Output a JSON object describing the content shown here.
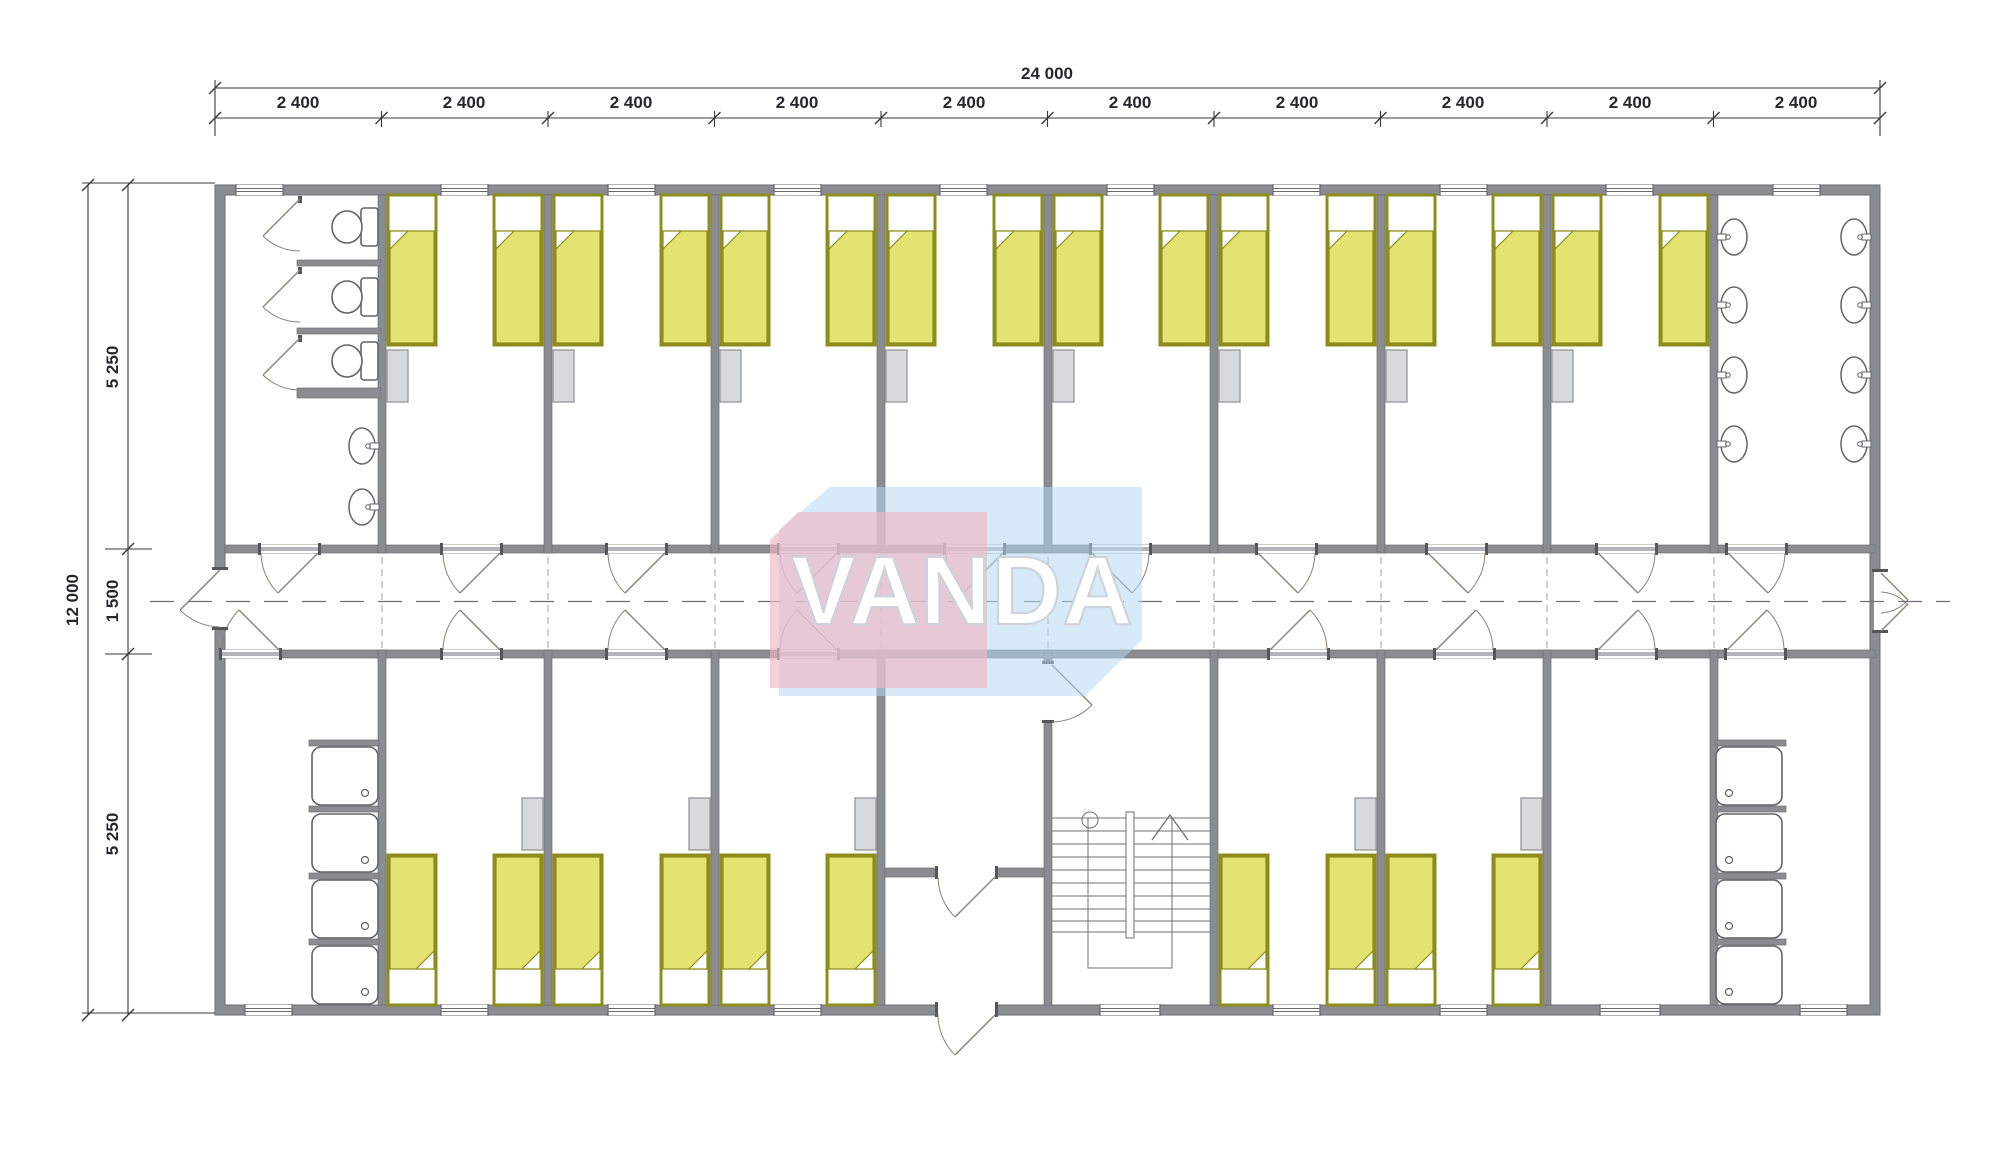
{
  "watermark": {
    "text": "VANDA",
    "pink_color": "#eeb7c4",
    "blue_color": "#b5d8f0"
  },
  "dimensions": {
    "top_total": "24 000",
    "top_bays": [
      "2 400",
      "2 400",
      "2 400",
      "2 400",
      "2 400",
      "2 400",
      "2 400",
      "2 400",
      "2 400",
      "2 400"
    ],
    "left_total": "12 000",
    "left_top": "5 250",
    "left_middle": "1 500",
    "left_bottom": "5 250"
  },
  "plan": {
    "colors": {
      "wall": "#8b8c90",
      "wall_edge": "#6d6e71",
      "bed_frame": "#8d8d1d",
      "bed_fill": "#e3e372",
      "pillow": "#ffffff",
      "wardrobe": "#d8d9da",
      "fixture_line": "#636467",
      "door_line": "#8a8178"
    },
    "rooms_top": [
      "wc-room",
      "bedroom",
      "bedroom",
      "bedroom",
      "bedroom",
      "bedroom",
      "bedroom",
      "bedroom",
      "bedroom",
      "washroom"
    ],
    "rooms_bottom": [
      "shower-room",
      "bedroom",
      "bedroom",
      "bedroom",
      "entrance-vestibule",
      "stair-hall",
      "bedroom",
      "bedroom",
      "utility-room",
      "shower-room"
    ],
    "counts": {
      "beds": 26,
      "toilets": 3,
      "washbasins": 10,
      "showers": 8,
      "wardrobes": 13,
      "bedrooms": 13
    }
  }
}
